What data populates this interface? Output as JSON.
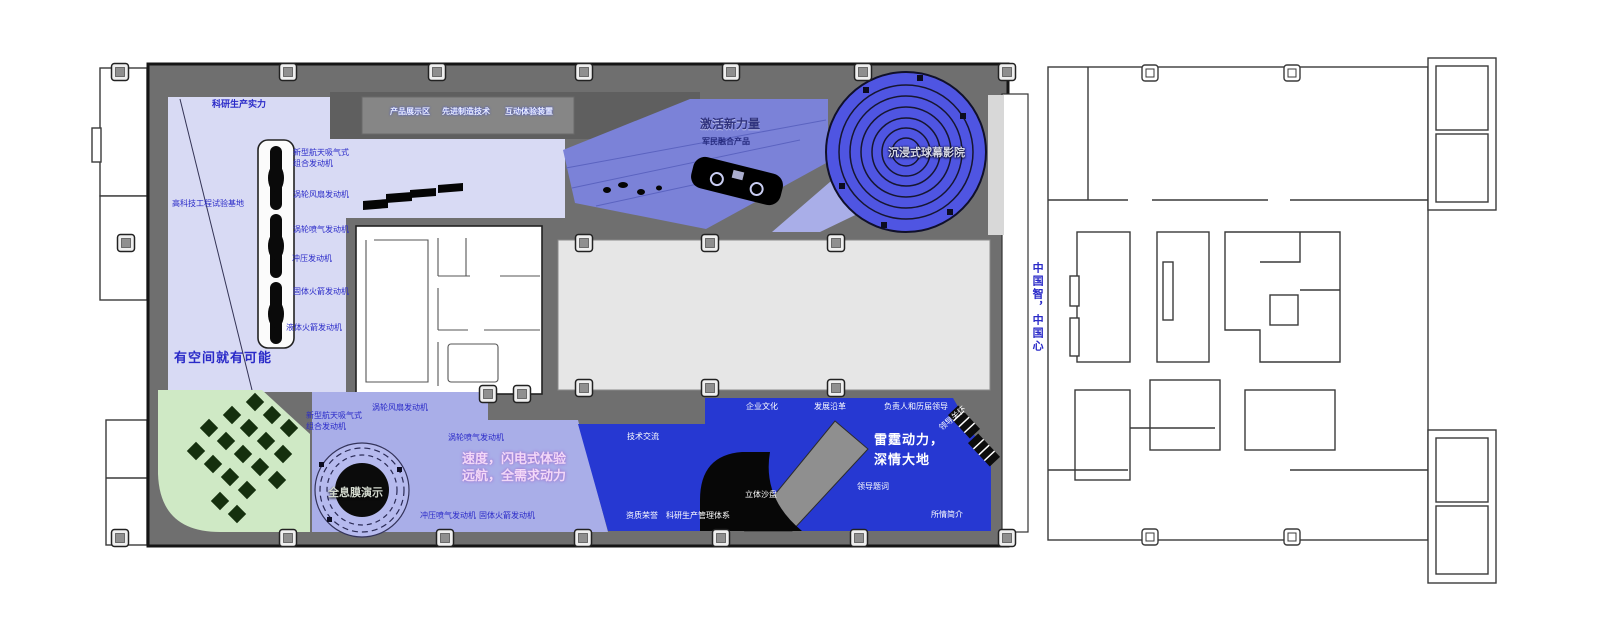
{
  "plan": {
    "colors": {
      "wall_gray": "#6f6f6f",
      "lavender": "#d8daf4",
      "mid_lavender": "#a9aee8",
      "slant_blue": "#7b82d8",
      "dome_blue": "#4f55e2",
      "deep_blue": "#2638d2",
      "green": "#cfe9c5",
      "hall_gray": "#e6e6e6",
      "label_blue": "#2a2ac8"
    },
    "northwest": {
      "title": "科研生产实力",
      "base_label": "高科技工程试验基地",
      "slogan": "有空间就有可能",
      "engine_line1": "新型航天吸气式",
      "engine_line2": "组合发动机",
      "engines": [
        "涡轮风扇发动机",
        "涡轮喷气发动机",
        "冲压发动机",
        "固体火箭发动机",
        "液体火箭发动机"
      ]
    },
    "top_wall": {
      "exhibits": [
        "产品展示区",
        "先进制造技术",
        "互动体验装置"
      ]
    },
    "new_power": {
      "title": "激活新力量",
      "subtitle": "军民融合产品"
    },
    "dome_theater": {
      "label": "沉浸式球幕影院"
    },
    "east_corridor": {
      "label": "中国智，中国心"
    },
    "southwest": {
      "holo_label": "全息膜演示",
      "engine_line1": "新型航天吸气式",
      "engine_line2": "组合发动机",
      "engines": [
        "涡轮风扇发动机",
        "涡轮喷气发动机",
        "冲压喷气发动机",
        "固体火箭发动机"
      ],
      "slogan_line1": "速度，闪电式体验",
      "slogan_line2": "远航，全需求动力"
    },
    "southeast": {
      "slogan_line1": "雷霆动力，",
      "slogan_line2": "深情大地",
      "tech_exchange": "技术交流",
      "culture": "企业文化",
      "history": "发展沿革",
      "leaders": "负责人和历届领导",
      "leader_care": "领导关怀",
      "inscription": "领导题词",
      "sand_table": "立体沙盘",
      "honors": "资质荣誉",
      "management": "科研生产管理体系",
      "intro": "所情简介"
    }
  }
}
